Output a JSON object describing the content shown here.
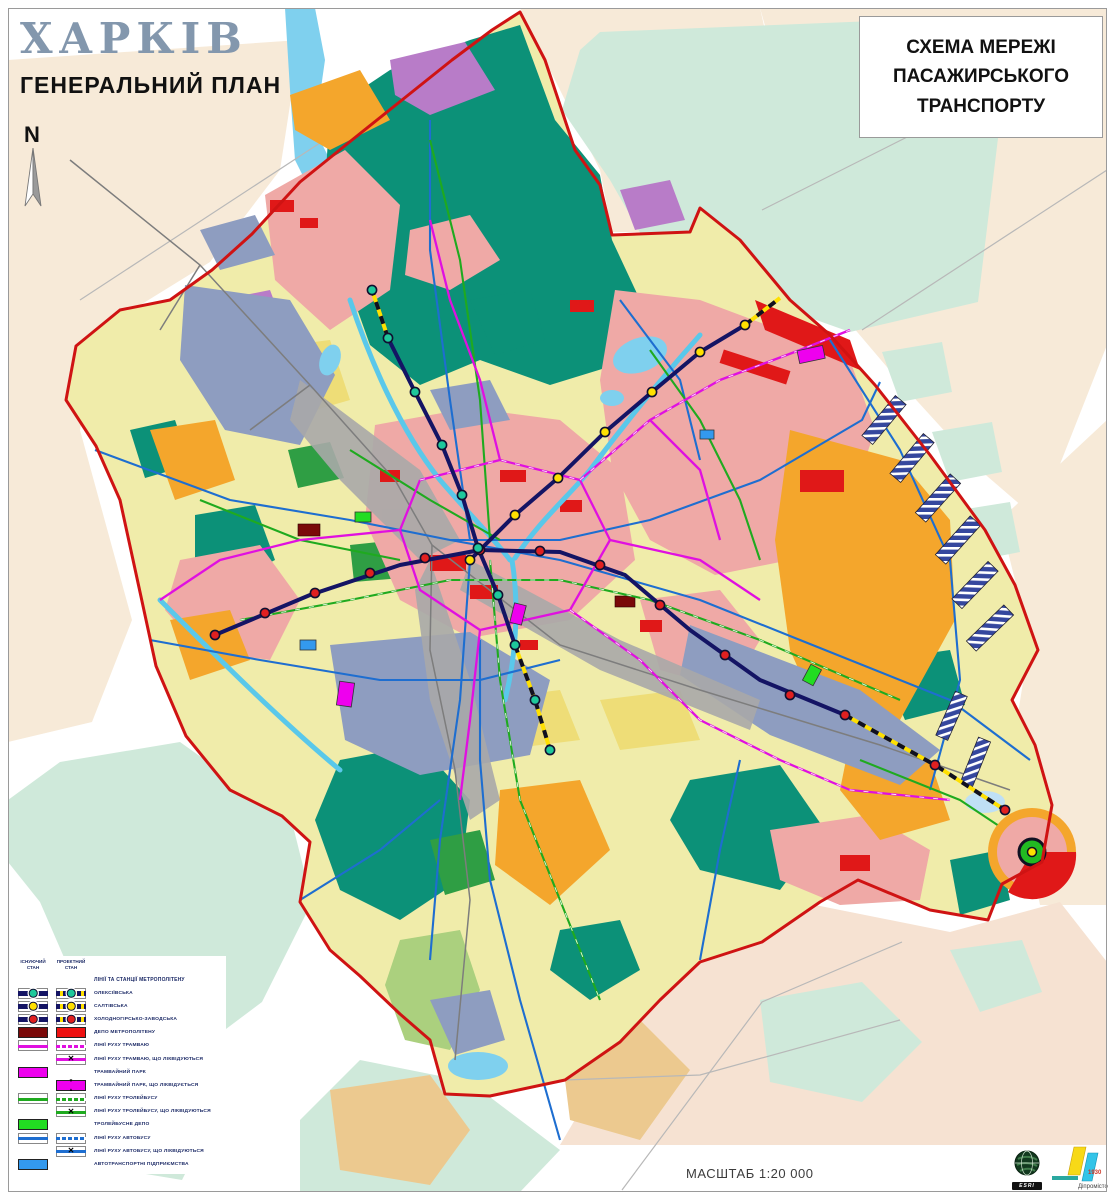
{
  "header": {
    "city": "ХАРКІВ",
    "plan": "ГЕНЕРАЛЬНИЙ ПЛАН",
    "scheme_title": "СХЕМА МЕРЕЖІ ПАСАЖИРСЬКОГО ТРАНСПОРТУ",
    "north_label": "N"
  },
  "legend": {
    "col_existing": "ІСНУЮЧИЙ СТАН",
    "col_projected": "ПРОЕКТНИЙ СТАН",
    "rows": [
      {
        "header": true,
        "label": "ЛІНІЇ ТА СТАНЦІЇ МЕТРОПОЛІТЕНУ"
      },
      {
        "existing": {
          "kind": "metro",
          "station": "#1ec89b"
        },
        "projected": {
          "kind": "metro-proj",
          "station": "#1ec89b"
        },
        "label": "ОЛЕКСІЇВСЬКА"
      },
      {
        "existing": {
          "kind": "metro",
          "station": "#ffe000"
        },
        "projected": {
          "kind": "metro-proj",
          "station": "#ffe000"
        },
        "label": "САЛТІВСЬКА"
      },
      {
        "existing": {
          "kind": "metro",
          "station": "#e02020"
        },
        "projected": {
          "kind": "metro-proj",
          "station": "#e02020"
        },
        "label": "ХОЛОДНОГІРСЬКО-ЗАВОДСЬКА"
      },
      {
        "existing": {
          "kind": "rect",
          "color": "#7a0909"
        },
        "projected": {
          "kind": "rect",
          "color": "#ee1111"
        },
        "label": "ДЕПО МЕТРОПОЛІТЕНУ"
      },
      {
        "existing": {
          "kind": "line",
          "color": "#e010e0"
        },
        "projected": {
          "kind": "line-proj",
          "color": "#e010e0"
        },
        "label": "ЛІНІЇ РУХУ ТРАМВАЮ"
      },
      {
        "projected": {
          "kind": "line-x",
          "color": "#e010e0"
        },
        "label": "ЛІНІЇ РУХУ ТРАМВАЮ, ЩО ЛІКВІДУЮТЬСЯ"
      },
      {
        "existing": {
          "kind": "rect",
          "color": "#ee00ee"
        },
        "label": "ТРАМВАЙНИЙ ПАРК"
      },
      {
        "projected": {
          "kind": "rect-x",
          "color": "#ee00ee"
        },
        "label": "ТРАМВАЙНИЙ ПАРК, ЩО ЛІКВІДУЄТЬСЯ"
      },
      {
        "existing": {
          "kind": "line",
          "color": "#1faa1f"
        },
        "projected": {
          "kind": "line-proj",
          "color": "#1faa1f"
        },
        "label": "ЛІНІЇ РУХУ ТРОЛЕЙБУСУ"
      },
      {
        "projected": {
          "kind": "line-x",
          "color": "#1faa1f"
        },
        "label": "ЛІНІЇ РУХУ ТРОЛЕЙБУСУ, ЩО ЛІКВІДУЮТЬСЯ"
      },
      {
        "existing": {
          "kind": "rect",
          "color": "#22dd22"
        },
        "label": "ТРОЛЕЙБУСНЕ ДЕПО"
      },
      {
        "existing": {
          "kind": "line",
          "color": "#1e6ed0"
        },
        "projected": {
          "kind": "line-proj",
          "color": "#1e6ed0"
        },
        "label": "ЛІНІЇ РУХУ АВТОБУСУ"
      },
      {
        "projected": {
          "kind": "line-x",
          "color": "#1e6ed0"
        },
        "label": "ЛІНІЇ РУХУ АВТОБУСУ, ЩО ЛІКВІДУЮТЬСЯ"
      },
      {
        "existing": {
          "kind": "rect",
          "color": "#3399ee"
        },
        "label": "АВТОТРАНСПОРТНІ ПІДПРИЄМСТВА"
      }
    ]
  },
  "footer": {
    "scale": "МАСШТАБ 1:20 000"
  },
  "logos": {
    "esri": "ESRI",
    "dipromisto_year": "1930",
    "dipromisto_name": "Діпромісто"
  },
  "palette": {
    "boundary_red": "#cf1313",
    "metro_navy": "#141464",
    "tram_magenta": "#e010e0",
    "trolleybus_green": "#1faa1f",
    "bus_blue": "#1e6ed0",
    "forest_teal": "#0c9178",
    "residential_pink": "#efa9a6",
    "dense_red": "#e01818",
    "gardens_orange": "#f4a62c",
    "industrial_grayblue": "#8e9dc0",
    "lowrise_yellow": "#f0ecaa",
    "water_blue": "#7fd0ee",
    "outside_cream": "#f7ead8",
    "outside_mint": "#cfe9da"
  }
}
